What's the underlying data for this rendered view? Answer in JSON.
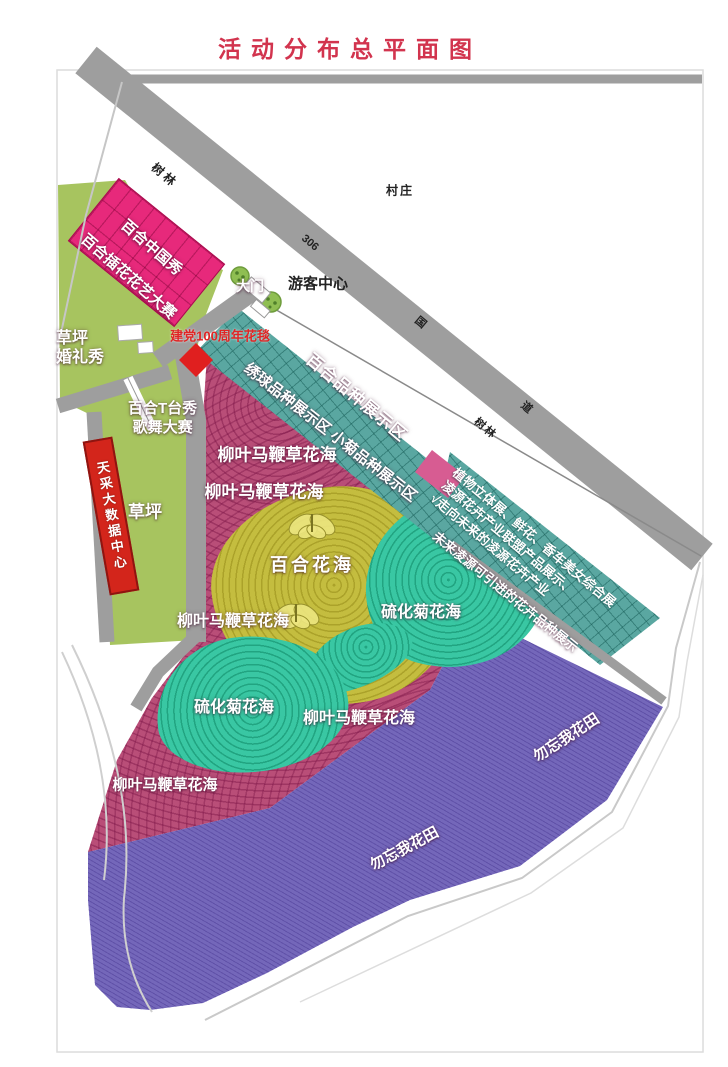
{
  "title": "活动分布总平面图",
  "roads": {
    "national_route_number": "306",
    "national_route_suffix_1": "国",
    "national_route_suffix_2": "道"
  },
  "context_labels": {
    "village": "村庄",
    "woods_upper": "树林",
    "woods_lower": "树林"
  },
  "entrance": {
    "gate": "大门",
    "visitor_center": "游客中心"
  },
  "venues": {
    "lily_china_show": "百合中国秀",
    "lily_flower_arrangement_contest": "百合插花花艺大赛",
    "lawn_wedding_show_line1": "草坪",
    "lawn_wedding_show_line2": "婚礼秀",
    "party_100th_flower_carpet": "建党100周年花毯",
    "lily_t_stage_show": "百合T台秀",
    "song_dance_contest": "歌舞大赛",
    "big_data_center": "天采大数据中心",
    "lawn": "草坪"
  },
  "display_zones": {
    "lily_variety_zone": "百合品种展示区",
    "hydrangea_and_small_chrysanthemum_zone": "绣球品种展示区 小菊品种展示区",
    "exhibition_lines": [
      "植物立体展、鲜花、香车美女综合展",
      "凌源花卉产业联盟产品展示、",
      "√走向未来的凌源花卉产业"
    ],
    "future_varieties_zone": "未来凌源可引进的花卉品种展示"
  },
  "flower_fields": {
    "verbena_labels": [
      "柳叶马鞭草花海",
      "柳叶马鞭草花海",
      "柳叶马鞭草花海",
      "柳叶马鞭草花海",
      "柳叶马鞭草花海"
    ],
    "lily_sea": "百合花海",
    "sulfur_chrysanthemum_labels": [
      "硫化菊花海",
      "硫化菊花海"
    ],
    "forget_me_not_labels": [
      "勿忘我花田",
      "勿忘我花田"
    ]
  },
  "colors": {
    "title_red": "#D2344E",
    "road_gray": "#9E9E9E",
    "building_pink": "#E7297B",
    "lawn_green": "#A7C45F",
    "display_teal": "#5AA7A1",
    "flower_mauve": "#B94E78",
    "lily_yellow": "#C4BD3F",
    "sulfur_teal": "#39C7A3",
    "forget_me_not_purple": "#7467BA",
    "data_center_red": "#D3251B",
    "carpet_red": "#E01F1F"
  }
}
